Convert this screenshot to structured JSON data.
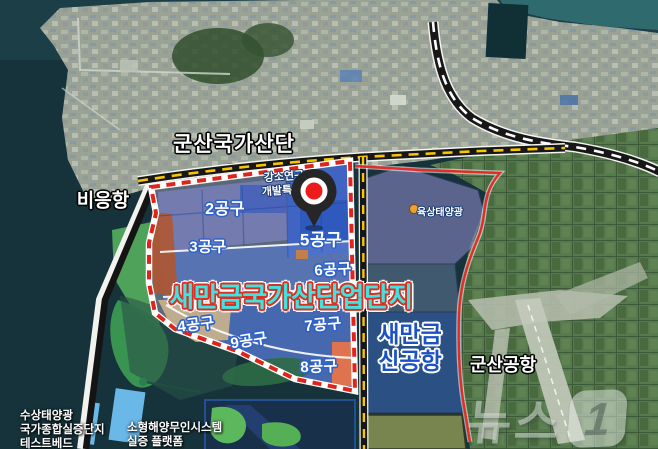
{
  "labels": {
    "gunsan_national_complex": "군산국가산단",
    "bieung_port": "비응항",
    "rnd_special_zone_line1": "강소연구",
    "rnd_special_zone_line2": "개발특구",
    "onshore_solar": "육상태양광",
    "main_title": "새만금국가산단업단지",
    "new_airport_line1": "새만금",
    "new_airport_line2": "신공항",
    "gunsan_airport": "군산공항",
    "floating_solar_line1": "수상태양광",
    "floating_solar_line2": "국가종합실증단지",
    "floating_solar_line3": "테스트베드",
    "marine_unmanned_line1": "소형해양무인시스템",
    "marine_unmanned_line2": "실증 플랫폼"
  },
  "zones": [
    {
      "label": "2공구"
    },
    {
      "label": "3공구"
    },
    {
      "label": "5공구"
    },
    {
      "label": "6공구"
    },
    {
      "label": "4공구"
    },
    {
      "label": "9공구"
    },
    {
      "label": "7공구"
    },
    {
      "label": "8공구"
    }
  ],
  "watermark": {
    "brand": "뉴스",
    "number": "1"
  },
  "colors": {
    "sea": "#16333b",
    "boundary_red": "#e0241c",
    "road_yellow": "#f7c600",
    "title_fill": "#3fe3df",
    "title_outline": "#d93025",
    "airport_text_blue": "#1b52c4",
    "zone_label_outline": "#2f62c9",
    "marker_red": "#ec1c1c",
    "onshore_solar_dot": "#f0a030"
  }
}
